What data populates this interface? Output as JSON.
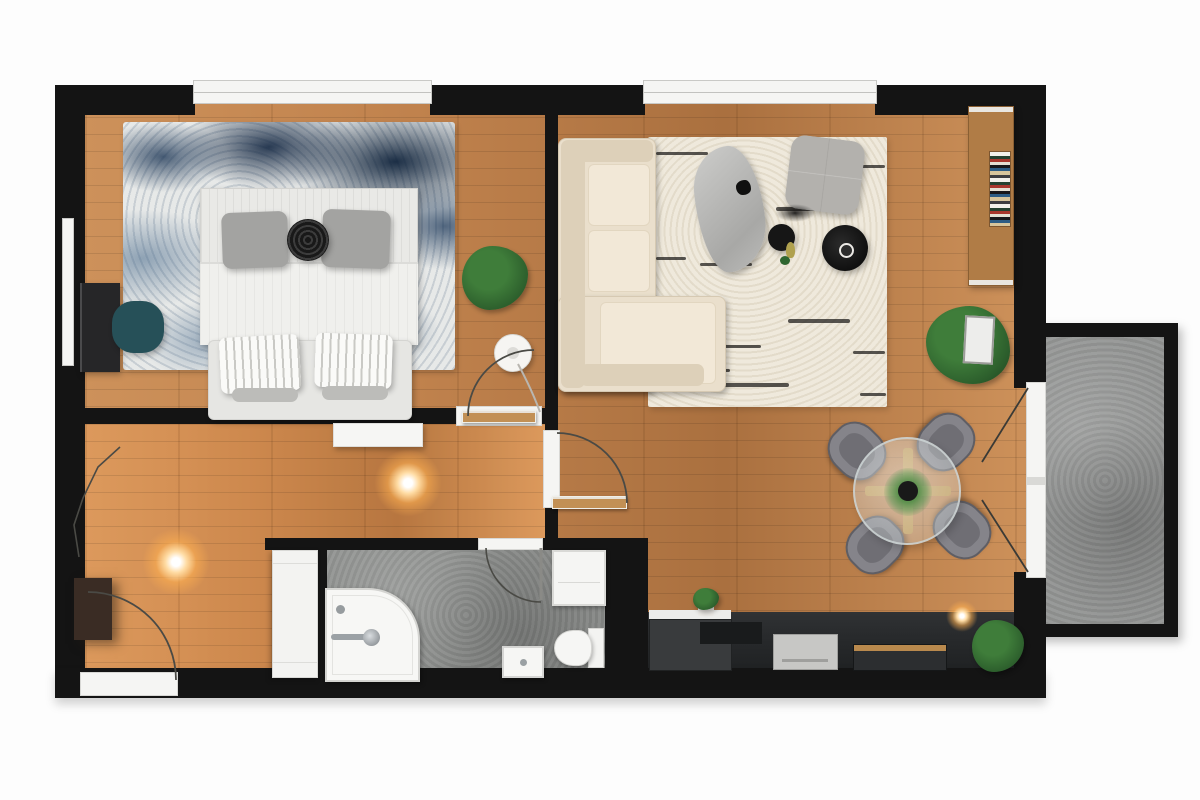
{
  "palette": {
    "wall": "#141414",
    "wood": "#c0824d",
    "wood-light": "#cd915a",
    "wood-dark": "#aa703f",
    "bath-floor": "#8d8f8d",
    "balcony-floor": "#939594",
    "white": "#f5f5f3",
    "rug-base": "#e7e9e8",
    "rug-living": "#efe9dc",
    "sofa": "#eadfcc",
    "sofa-light": "#f2e8d7",
    "sofa-dark": "#ddd0b9",
    "gray-furn": "#b3b1ad",
    "chair-gray": "#85848a",
    "chair-seat": "#6f6e74",
    "teal": "#265058",
    "desk": "#262628",
    "black-furn": "#161616",
    "plant": "#3f7d3a",
    "plant-dark": "#2c5e2c",
    "kitchen-dark": "#26282a",
    "cabinet": "#393b3d",
    "wood-shelf": "#b07c46",
    "door-wood": "#c29055",
    "entry-door": "#3a2c24",
    "appliance": "#c7c7c5",
    "line": "#4a4a45"
  },
  "plan": {
    "type": "apartment-floor-plan-top-view",
    "rooms": [
      {
        "id": "bedroom",
        "furniture": [
          "double-bed",
          "gray-pillows",
          "round-black-pillow",
          "foot-bench",
          "blue-mottled-rug",
          "desk",
          "teal-chair",
          "radiator",
          "potted-plant",
          "floor-lamp",
          "window"
        ]
      },
      {
        "id": "living-room",
        "furniture": [
          "corner-sofa",
          "cream-rug",
          "organic-coffee-table",
          "gray-pouf",
          "black-side-table-small",
          "black-side-table-large",
          "bookshelf-with-books",
          "potted-plant",
          "window",
          "balcony-french-doors"
        ]
      },
      {
        "id": "dining-area",
        "furniture": [
          "round-glass-table",
          "wood-cross-base",
          "table-centerpiece-plant",
          "dining-chair-x4"
        ]
      },
      {
        "id": "hallway",
        "furniture": [
          "white-console",
          "tall-white-cabinet",
          "ceiling-light-x2",
          "entry-door",
          "coat-area"
        ]
      },
      {
        "id": "bathroom",
        "furniture": [
          "corner-bathtub",
          "faucet",
          "sink",
          "toilet",
          "washing-machine",
          "door"
        ]
      },
      {
        "id": "kitchen",
        "furniture": [
          "dark-counter-run",
          "white-counter-section",
          "appliance",
          "island-wood-top",
          "small-plant",
          "large-plant",
          "ceiling-light"
        ]
      },
      {
        "id": "balcony",
        "furniture": [
          "stone-floor",
          "sliding-frame"
        ]
      }
    ],
    "doors": [
      "entry-door-bottom-left",
      "bedroom-door",
      "living-room-door",
      "bathroom-door",
      "balcony-double-door"
    ],
    "windows": [
      "bedroom-top-window",
      "living-room-top-window"
    ]
  }
}
